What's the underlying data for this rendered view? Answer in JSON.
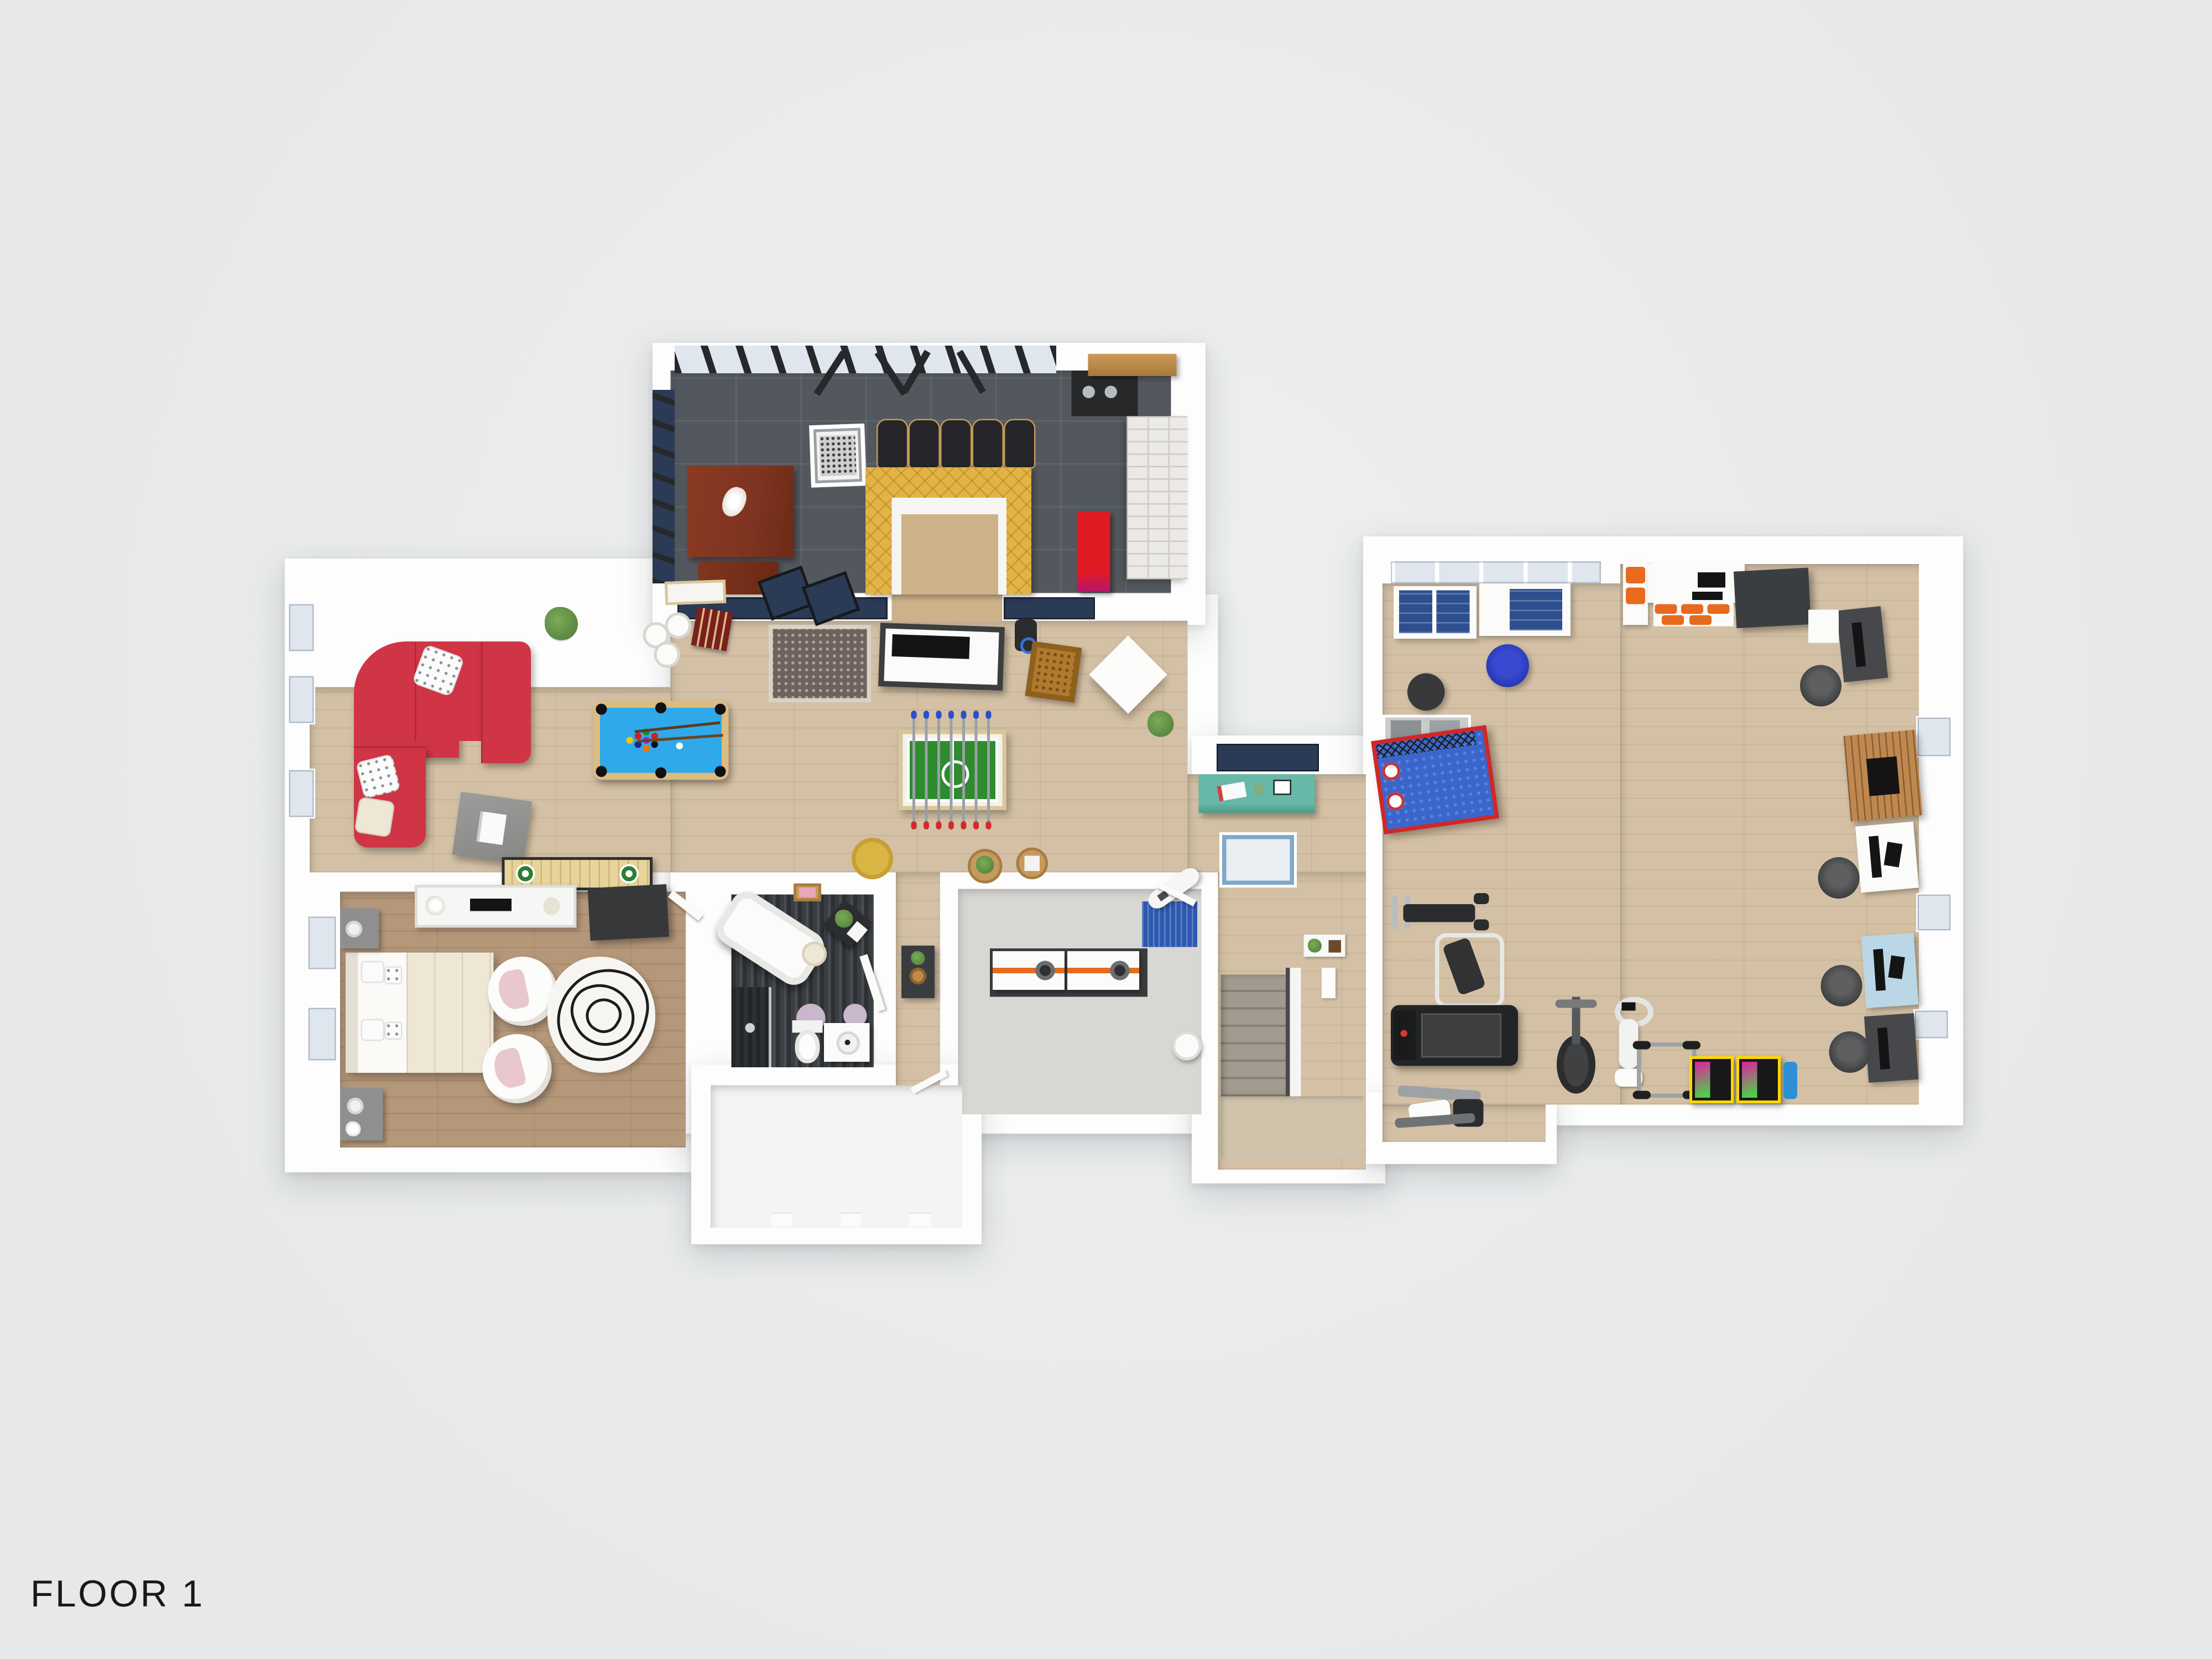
{
  "floor_label": "FLOOR 1",
  "palette": {
    "bg": "#e6e8e9",
    "wall": "#fdfdfd",
    "wood": "#d4c1a5",
    "wood_dark": "#b5987a",
    "tile": "#53585e",
    "mosaic_a": "#2e3134",
    "mosaic_b": "#4a4e52",
    "concrete": "#d9d7d4",
    "white_floor": "#f4f4f2",
    "landing": "#cfc3ab",
    "stairs_tread": "#a29a8e",
    "stairs_tread_dark": "#877f73",
    "bar_yellow": "#e3b445",
    "bar_inner_tan": "#cdb189",
    "brick_light": "#eceae6",
    "mahogany": "#7e3420",
    "chair_black": "#26262a",
    "chair_trim": "#c49a55",
    "window_glass": "#dfe6ee",
    "window_mullion": "#26282c",
    "window_sill_blue": "#2b3a55",
    "door_panel_blue": "#2b3a55",
    "sofa_red": "#cf3545",
    "pool_felt": "#2fa9ea",
    "pool_frame": "#dcbc80",
    "foosball_green": "#2e8b2e",
    "shuffle_wood": "#e6d49a",
    "shuffle_green": "#2e7d32",
    "teal": "#66b8a8",
    "rug_dark": "#6e635c",
    "rug_light": "#e8eef2",
    "rug_light_border": "#7fa8c8",
    "laundry_rug_blue": "#2d59b0",
    "lavender_rug": "#c9b7cc",
    "bed_blue": "#3a66cc",
    "frame_red": "#d22727",
    "orange": "#e86a1e",
    "arcade_yellow": "#ffd800",
    "arcade_screen_pink": "#e020a0",
    "arcade_screen_green": "#40e040",
    "arcade_body": "#18181a",
    "fireplace_wood": "#bf8850",
    "desk_dark": "#46484b",
    "desk_blue": "#b9d7e6",
    "desk_mat_blue": "#2e4f8e",
    "office_chair_gray": "#3e4042",
    "chair_blue": "#2937b8",
    "plant_green": "#4d7a3a",
    "cream": "#efe7d6",
    "nightstand_gray": "#8f8f8f",
    "wardrobe_dark": "#36383a",
    "pink_pillow": "#e8c8cc",
    "basket_tan": "#b07a2e",
    "speaker_dark": "#2a2c2e",
    "arcade_red": "#e01b24",
    "rod_blue": "#2b4ecb",
    "rod_red": "#d12b2b",
    "label_color": "#191919"
  }
}
